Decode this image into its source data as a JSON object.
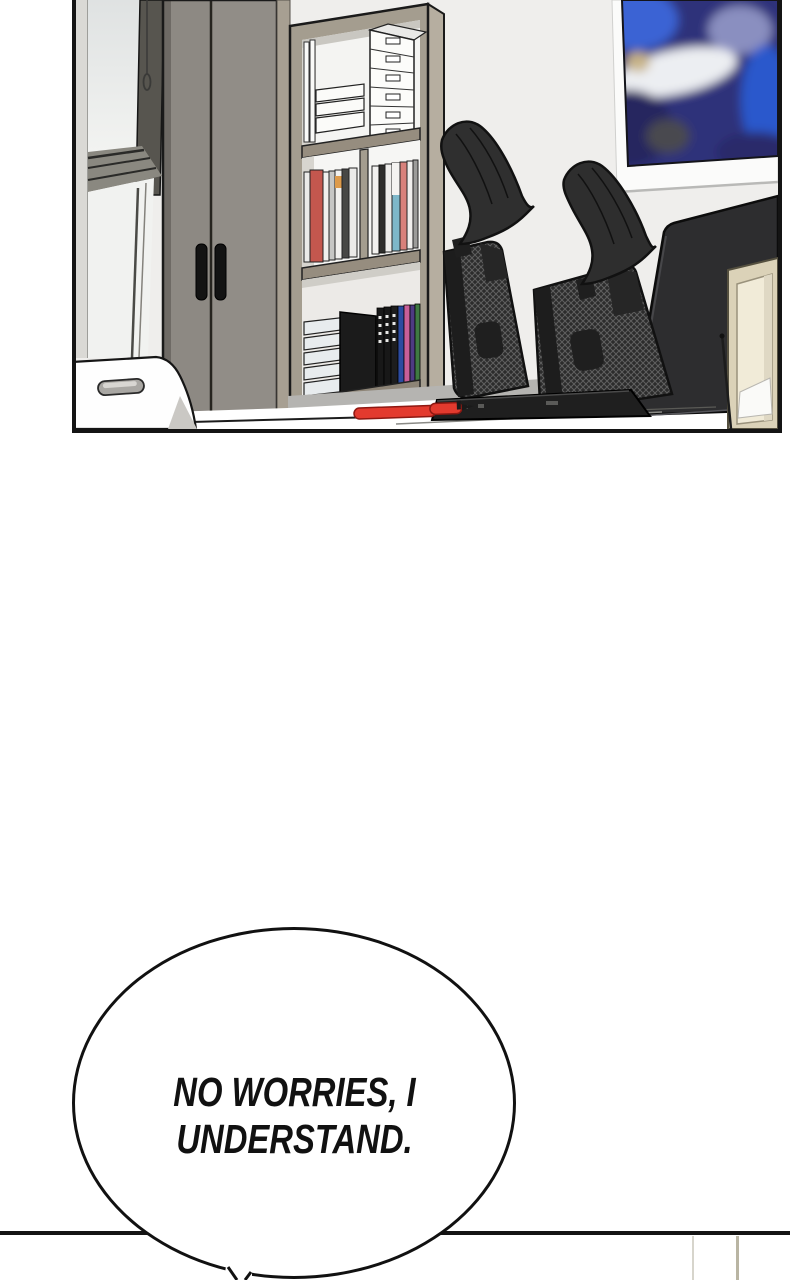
{
  "page": {
    "background": "#ffffff"
  },
  "office_panel": {
    "border_color": "#141414",
    "wall_color": "#efeeec"
  },
  "speech_bubble": {
    "line1": "NO WORRIES, I",
    "line2": "UNDERSTAND.",
    "fill": "#ffffff",
    "border_color": "#111111",
    "text_color": "#111111"
  },
  "next_panel": {
    "border_color": "#141414"
  },
  "palette": {
    "pen_red": "#e33a2e",
    "photo_blue": "#3a64d4",
    "cabinet_grey": "#8d8983",
    "bookshelf_taupe": "#a49d8f",
    "chair_black": "#2c2c2c",
    "easel_beige": "#dbd2b8"
  }
}
